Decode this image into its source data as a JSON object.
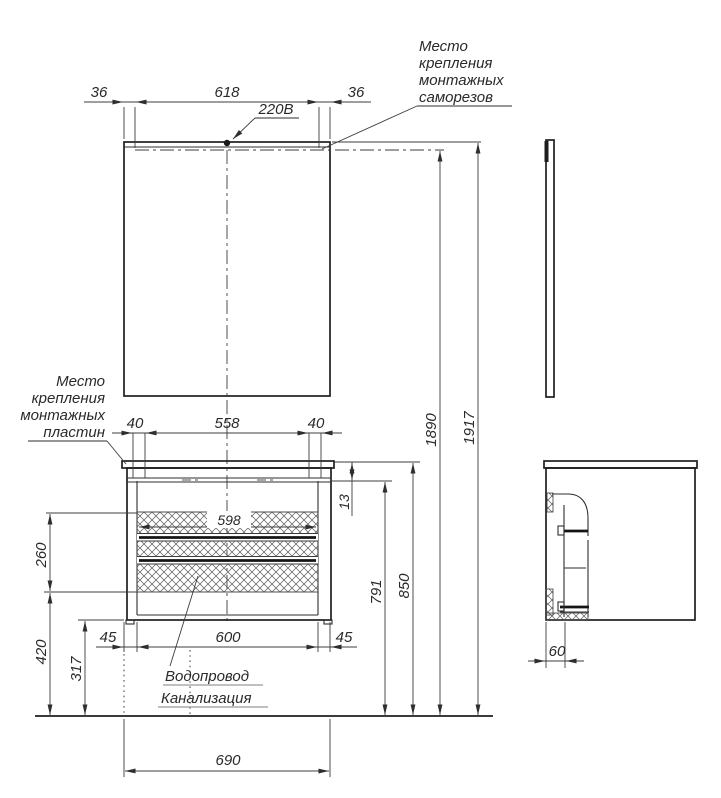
{
  "drawing": {
    "mirror": {
      "dim_margin_left": "36",
      "dim_screw_span": "618",
      "dim_margin_right": "36",
      "power_label": "220В",
      "screws_note_line1": "Место",
      "screws_note_line2": "крепления",
      "screws_note_line3": "монтажных",
      "screws_note_line4": "саморезов"
    },
    "heights": {
      "mount_height": "1890",
      "total_height": "1917"
    },
    "vanity": {
      "plate_offset_left": "40",
      "plate_span": "558",
      "plate_offset_right": "40",
      "plate_drop": "13",
      "zone_width": "598",
      "zone_height": "260",
      "rail_height": "791",
      "counter_height": "850",
      "leg_offset_left": "45",
      "leg_span": "600",
      "leg_offset_right": "45",
      "zone_bottom_to_floor": "420",
      "cabinet_bottom_to_floor": "317",
      "total_width": "690",
      "side_inset": "60",
      "plates_note_line1": "Место",
      "plates_note_line2": "крепления",
      "plates_note_line3": "монтажных",
      "plates_note_line4": "пластин",
      "plumbing_note_line1": "Водопровод",
      "plumbing_note_line2": "Канализация"
    },
    "colors": {
      "line": "#2e2e2e",
      "background": "#ffffff"
    }
  }
}
